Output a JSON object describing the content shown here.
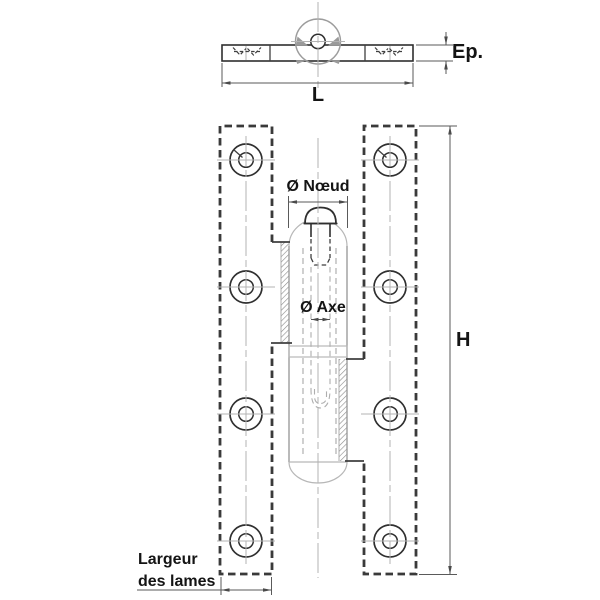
{
  "drawing": {
    "labels": {
      "thickness": "Ep.",
      "overall_length": "L",
      "knuckle_diameter": "Ø Nœud",
      "pin_diameter": "Ø Axe",
      "overall_height": "H",
      "leaf_width_line1": "Largeur",
      "leaf_width_line2": "des lames"
    },
    "colors": {
      "background": "#ffffff",
      "outline": "#2f2f2f",
      "plate_border": "#3a3a3a",
      "dimension_lines": "#5a5a5a",
      "centerlines": "#b3b3b3",
      "hatch": "#8a8a8a",
      "label_text": "#141414"
    }
  }
}
